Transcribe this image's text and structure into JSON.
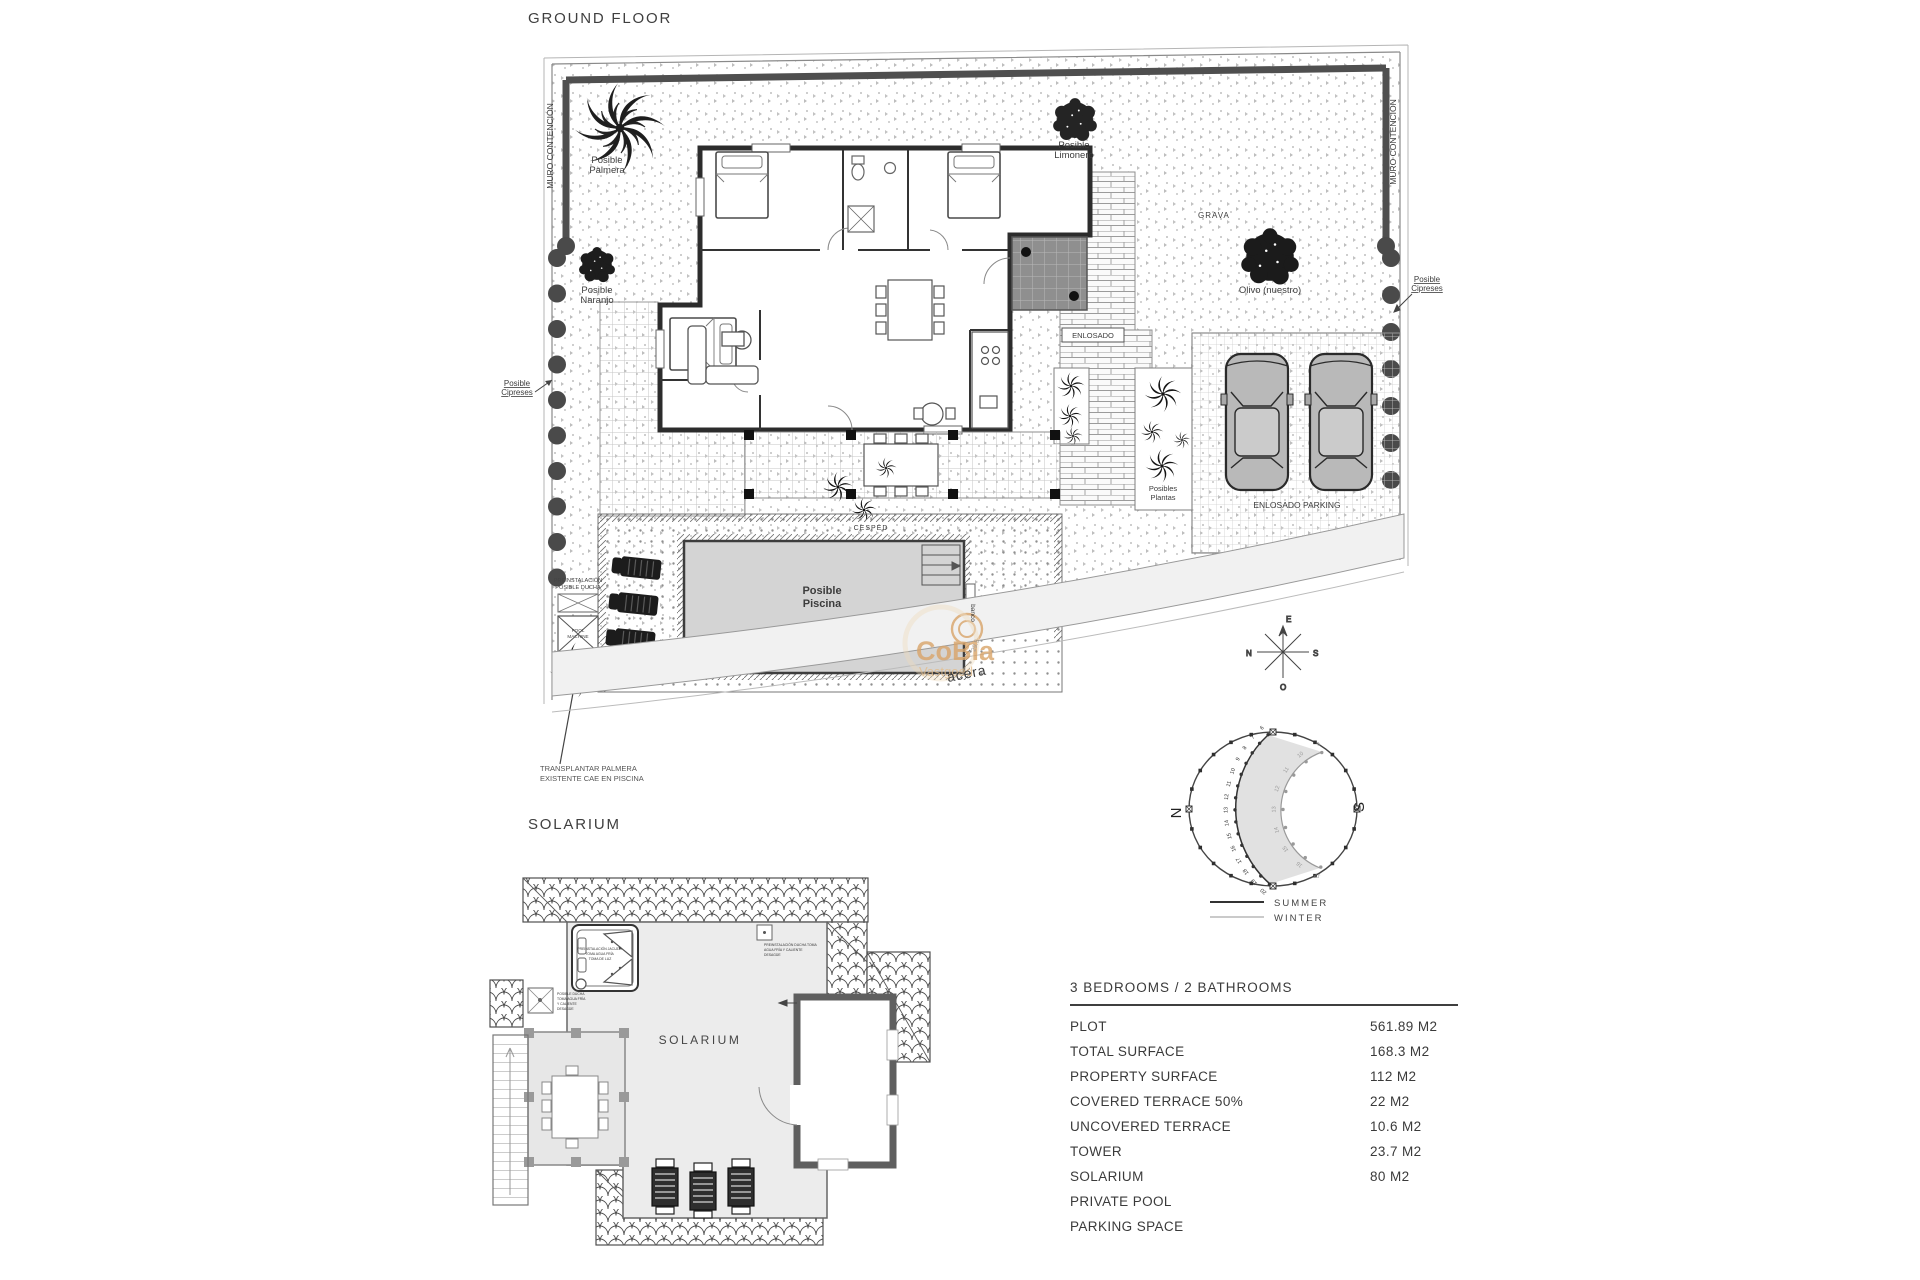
{
  "titles": {
    "ground_floor": "GROUND FLOOR",
    "solarium": "SOLARIUM"
  },
  "site": {
    "muro_left": "MURO CONTENCIÓN",
    "muro_right": "MURO CONTENCIÓN",
    "palmera": {
      "l1": "Posible",
      "l2": "Palmera"
    },
    "limonero": {
      "l1": "Posible",
      "l2": "Limonero"
    },
    "naranjo": {
      "l1": "Posible",
      "l2": "Naranjo"
    },
    "olivo": "Olivo (nuestro)",
    "grava": "GRAVA",
    "cipreses_left": {
      "l1": "Posible",
      "l2": "Cipreses"
    },
    "cipreses_right": {
      "l1": "Posible",
      "l2": "Cipreses"
    },
    "enlosado": "ENLOSADO",
    "plantas": {
      "l1": "Posibles",
      "l2": "Plantas"
    },
    "enlosado_parking": "ENLOSADO PARKING",
    "cesped": "CESPED",
    "banco": "banco",
    "piscina": {
      "l1": "Posible",
      "l2": "Piscina"
    },
    "pool_machine": {
      "l1": "POOL",
      "l2": "MACHINE"
    },
    "preinst": {
      "l1": "PREINSTALACIÓN",
      "l2": "POSIBLE DUCHA"
    },
    "acera": "acera",
    "dim": "29.5",
    "transplantar": {
      "l1": "TRANSPLANTAR PALMERA",
      "l2": "EXISTENTE  CAE EN PISCINA"
    },
    "compass": {
      "n": "N",
      "s": "S",
      "e": "E",
      "o": "O"
    }
  },
  "sun": {
    "n": "N",
    "s": "S",
    "summer_label": "SUMMER",
    "winter_label": "WINTER",
    "summer_hours": [
      6,
      7,
      8,
      9,
      10,
      11,
      12,
      13,
      14,
      15,
      16,
      17,
      18,
      19,
      20
    ],
    "winter_hours": [
      9,
      10,
      11,
      12,
      13,
      14,
      15,
      16,
      17
    ]
  },
  "solarium": {
    "room_label": "SOLARIUM",
    "jacuzzi_note": {
      "l1": "PREINSTALACIÓN JACUZZI",
      "l2": "TOMA AGUA FRÍA",
      "l3": "TOMA DE LUZ"
    },
    "ducha_note": {
      "l1": "POSIBLE DUCHA",
      "l2": "TOMA AGUA FRÍA",
      "l3": "Y CALIENTE",
      "l4": "DESAGÜE"
    },
    "toma_note": {
      "l1": "PREINSTALACIÓN DUCHA TOMA",
      "l2": "AGUA FRÍA Y CALIENTE",
      "l3": "DESAGÜE"
    }
  },
  "watermark": {
    "l1": "CoBla",
    "l2": "Vastgoed",
    "color": "#d9a469"
  },
  "property": {
    "header": "3 BEDROOMS / 2 BATHROOMS",
    "rows": [
      {
        "label": "PLOT",
        "value": "561.89 M2"
      },
      {
        "label": "TOTAL SURFACE",
        "value": "168.3 M2"
      },
      {
        "label": "PROPERTY SURFACE",
        "value": "112 M2"
      },
      {
        "label": "COVERED TERRACE 50%",
        "value": "22 M2"
      },
      {
        "label": "UNCOVERED TERRACE",
        "value": "10.6 M2"
      },
      {
        "label": "TOWER",
        "value": "23.7 M2"
      },
      {
        "label": "SOLARIUM",
        "value": "80 M2"
      },
      {
        "label": "PRIVATE POOL",
        "value": ""
      },
      {
        "label": "PARKING SPACE",
        "value": ""
      }
    ]
  }
}
